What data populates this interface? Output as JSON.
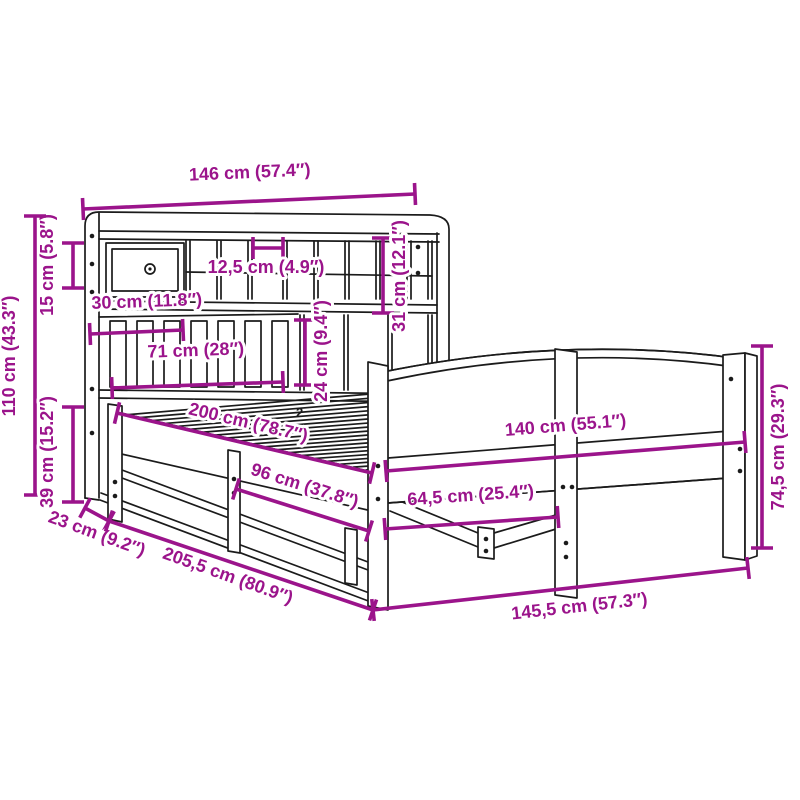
{
  "diagram": {
    "canvas": {
      "width": 800,
      "height": 800,
      "background": "#ffffff"
    },
    "colors": {
      "dimension": "#9B148B",
      "drawing": "#1b1b1b",
      "halo": "#ffffff"
    },
    "part_mark": "2",
    "dims": [
      {
        "id": "headboard-width",
        "label": "146 cm (57.4″)",
        "x1": 83,
        "y1": 209,
        "x2": 415,
        "y2": 194,
        "lx": 250,
        "ly": 178,
        "rot": -2.5
      },
      {
        "id": "top-shelf-height",
        "label": "15 cm (5.8″)",
        "x1": 73,
        "y1": 243,
        "x2": 73,
        "y2": 288,
        "lx": 53,
        "ly": 265,
        "rot": -90
      },
      {
        "id": "total-height",
        "label": "110 cm (43.3″)",
        "x1": 35,
        "y1": 216,
        "x2": 35,
        "y2": 495,
        "lx": 15,
        "ly": 356,
        "rot": -90
      },
      {
        "id": "base-height",
        "label": "39 cm (15.2″)",
        "x1": 73,
        "y1": 407,
        "x2": 73,
        "y2": 502,
        "lx": 53,
        "ly": 452,
        "rot": -90
      },
      {
        "id": "cubby-width",
        "label": "12,5 cm (4.9″)",
        "x1": 253,
        "y1": 248,
        "x2": 283,
        "y2": 248,
        "lx": 266,
        "ly": 273,
        "rot": 0
      },
      {
        "id": "drawer-width",
        "label": "30 cm (11.8″)",
        "x1": 90,
        "y1": 334,
        "x2": 183,
        "y2": 330,
        "lx": 147,
        "ly": 307,
        "rot": -2
      },
      {
        "id": "lower-shelf-width",
        "label": "71 cm (28″)",
        "x1": 112,
        "y1": 388,
        "x2": 283,
        "y2": 382,
        "lx": 196,
        "ly": 356,
        "rot": -2
      },
      {
        "id": "cubby-height",
        "label": "31 cm (12.1″)",
        "x1": 383,
        "y1": 238,
        "x2": 383,
        "y2": 313,
        "lx": 405,
        "ly": 276,
        "rot": -90
      },
      {
        "id": "slot-height",
        "label": "24 cm (9.4″)",
        "x1": 305,
        "y1": 320,
        "x2": 305,
        "y2": 385,
        "lx": 327,
        "ly": 351,
        "rot": -90
      },
      {
        "id": "mattress-length",
        "label": "200 cm (78.7″)",
        "x1": 117,
        "y1": 413,
        "x2": 372,
        "y2": 473,
        "lx": 247,
        "ly": 428,
        "rot": 13.2
      },
      {
        "id": "rail-length",
        "label": "96 cm (37.8″)",
        "x1": 236,
        "y1": 489,
        "x2": 369,
        "y2": 531,
        "lx": 303,
        "ly": 491,
        "rot": 17.5
      },
      {
        "id": "mattress-width",
        "label": "140 cm (55.1″)",
        "x1": 386,
        "y1": 471,
        "x2": 745,
        "y2": 442,
        "lx": 566,
        "ly": 431,
        "rot": -4.7
      },
      {
        "id": "half-width",
        "label": "64,5 cm (25.4″)",
        "x1": 385,
        "y1": 529,
        "x2": 558,
        "y2": 517,
        "lx": 471,
        "ly": 501,
        "rot": -4
      },
      {
        "id": "footboard-height",
        "label": "74,5 cm (29.3″)",
        "x1": 762,
        "y1": 346,
        "x2": 762,
        "y2": 548,
        "lx": 784,
        "ly": 447,
        "rot": -90
      },
      {
        "id": "headboard-depth",
        "label": "23 cm (9.2″)",
        "x1": 85,
        "y1": 508,
        "x2": 109,
        "y2": 521,
        "lx": 95,
        "ly": 539,
        "rot": 20
      },
      {
        "id": "total-length",
        "label": "205,5 cm (80.9″)",
        "x1": 109,
        "y1": 521,
        "x2": 373,
        "y2": 610,
        "lx": 226,
        "ly": 581,
        "rot": 19.7
      },
      {
        "id": "total-width",
        "label": "145,5 cm (57.3″)",
        "x1": 373,
        "y1": 610,
        "x2": 748,
        "y2": 568,
        "lx": 580,
        "ly": 612,
        "rot": -6.3
      }
    ]
  }
}
